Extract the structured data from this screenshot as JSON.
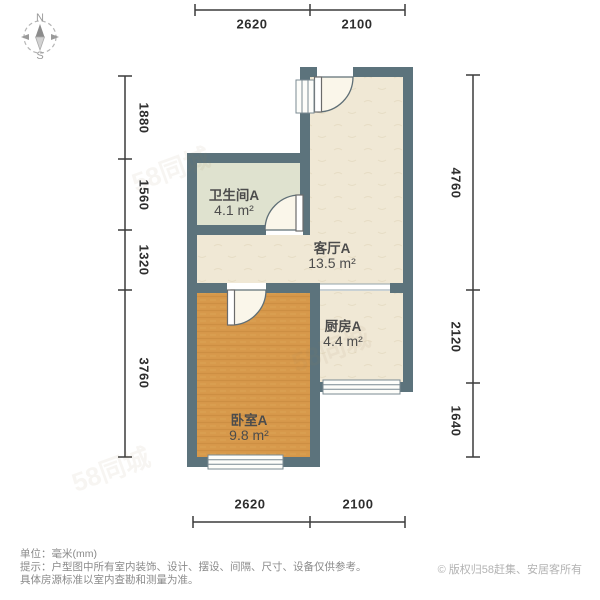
{
  "compass": {
    "north_label": "N",
    "south_label": "S"
  },
  "dimensions": {
    "top": [
      {
        "value": "2620"
      },
      {
        "value": "2100"
      }
    ],
    "bottom": [
      {
        "value": "2620"
      },
      {
        "value": "2100"
      }
    ],
    "left": [
      {
        "value": "1880"
      },
      {
        "value": "1560"
      },
      {
        "value": "1320"
      },
      {
        "value": "3760"
      }
    ],
    "right": [
      {
        "value": "4760"
      },
      {
        "value": "2120"
      },
      {
        "value": "1640"
      }
    ]
  },
  "rooms": [
    {
      "name": "卫生间A",
      "area": "4.1 m²"
    },
    {
      "name": "客厅A",
      "area": "13.5 m²"
    },
    {
      "name": "厨房A",
      "area": "4.4 m²"
    },
    {
      "name": "卧室A",
      "area": "9.8 m²"
    }
  ],
  "footer": {
    "unit_line": "单位：毫米(mm)",
    "hint_line1": "提示：户型图中所有室内装饰、设计、摆设、间隔、尺寸、设备仅供参考。",
    "hint_line2": "具体房源标准以室内查勘和测量为准。",
    "copyright": "© 版权归58赶集、安居客所有"
  },
  "watermark_text": "58同城",
  "colors": {
    "wall": "#5c737c",
    "floor_living": "#f0e8d5",
    "floor_bathroom": "#dfe2cf",
    "floor_bedroom": "#d7994b",
    "dimension_line": "#3c3c3c",
    "room_text": "#4c4c4c",
    "footer_text": "#8a8a8a",
    "copyright_text": "#b3b3b3"
  }
}
